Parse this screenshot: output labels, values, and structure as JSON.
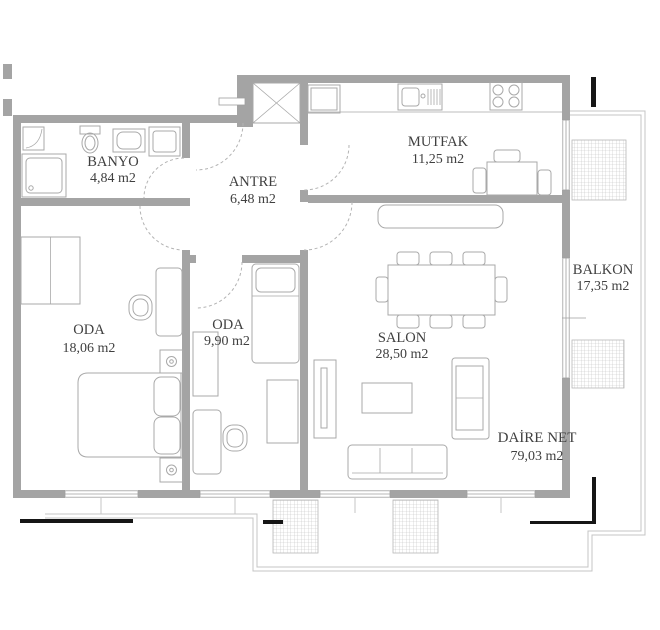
{
  "plan": {
    "title": "apartment floor plan",
    "rooms": [
      {
        "id": "banyo",
        "name": "BANYO",
        "area": "4,84 m2"
      },
      {
        "id": "antre",
        "name": "ANTRE",
        "area": "6,48 m2"
      },
      {
        "id": "mutfak",
        "name": "MUTFAK",
        "area": "11,25 m2"
      },
      {
        "id": "balkon",
        "name": "BALKON",
        "area": "17,35 m2"
      },
      {
        "id": "oda-large",
        "name": "ODA",
        "area": "18,06 m2"
      },
      {
        "id": "oda-small",
        "name": "ODA",
        "area": "9,90 m2"
      },
      {
        "id": "salon",
        "name": "SALON",
        "area": "28,50 m2"
      }
    ],
    "summary": {
      "label": "DAİRE NET",
      "area": "79,03 m2"
    },
    "colors": {
      "wall": "#a4a4a4",
      "furniture": "#a9a9a9",
      "text": "#404040",
      "hatch": "#c3c3c3",
      "outline": "#c4c4c4",
      "background": "#ffffff"
    }
  }
}
